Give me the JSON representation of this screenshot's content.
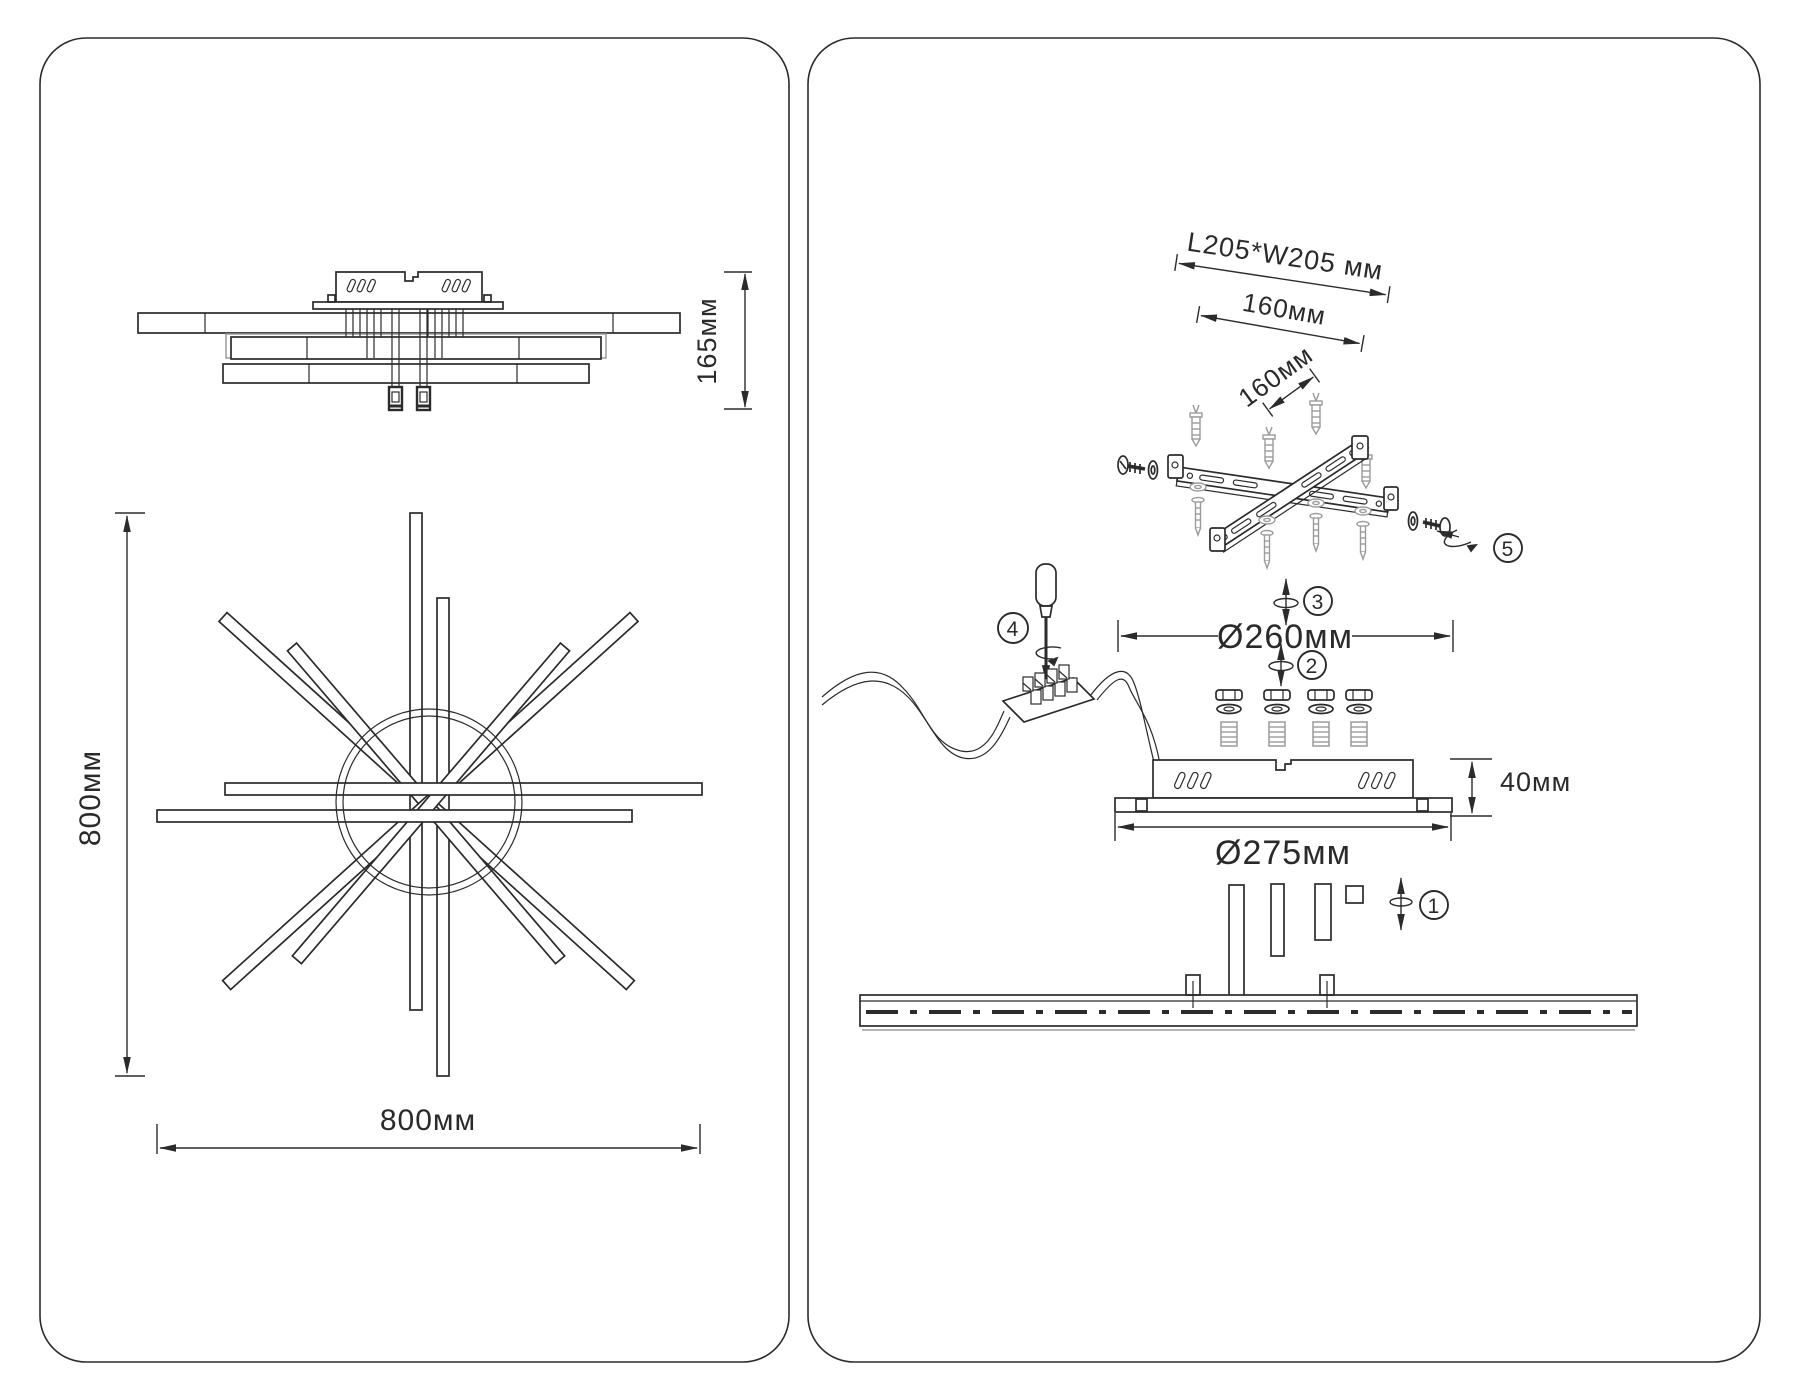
{
  "left_panel": {
    "side_view": {
      "height": "165мм"
    },
    "plan_view": {
      "height": "800мм",
      "width": "800мм"
    }
  },
  "right_panel": {
    "mount": {
      "plate": "L205*W205 мм",
      "span": "160мм",
      "pitch": "160мм"
    },
    "dims": {
      "ring": "Ø260мм",
      "base": "Ø275мм",
      "height": "40мм"
    },
    "steps": [
      "1",
      "2",
      "3",
      "4",
      "5"
    ]
  },
  "colors": {
    "line": "#2b2b2b",
    "hardware_gray": "#9b9b9b",
    "background": "#ffffff"
  }
}
